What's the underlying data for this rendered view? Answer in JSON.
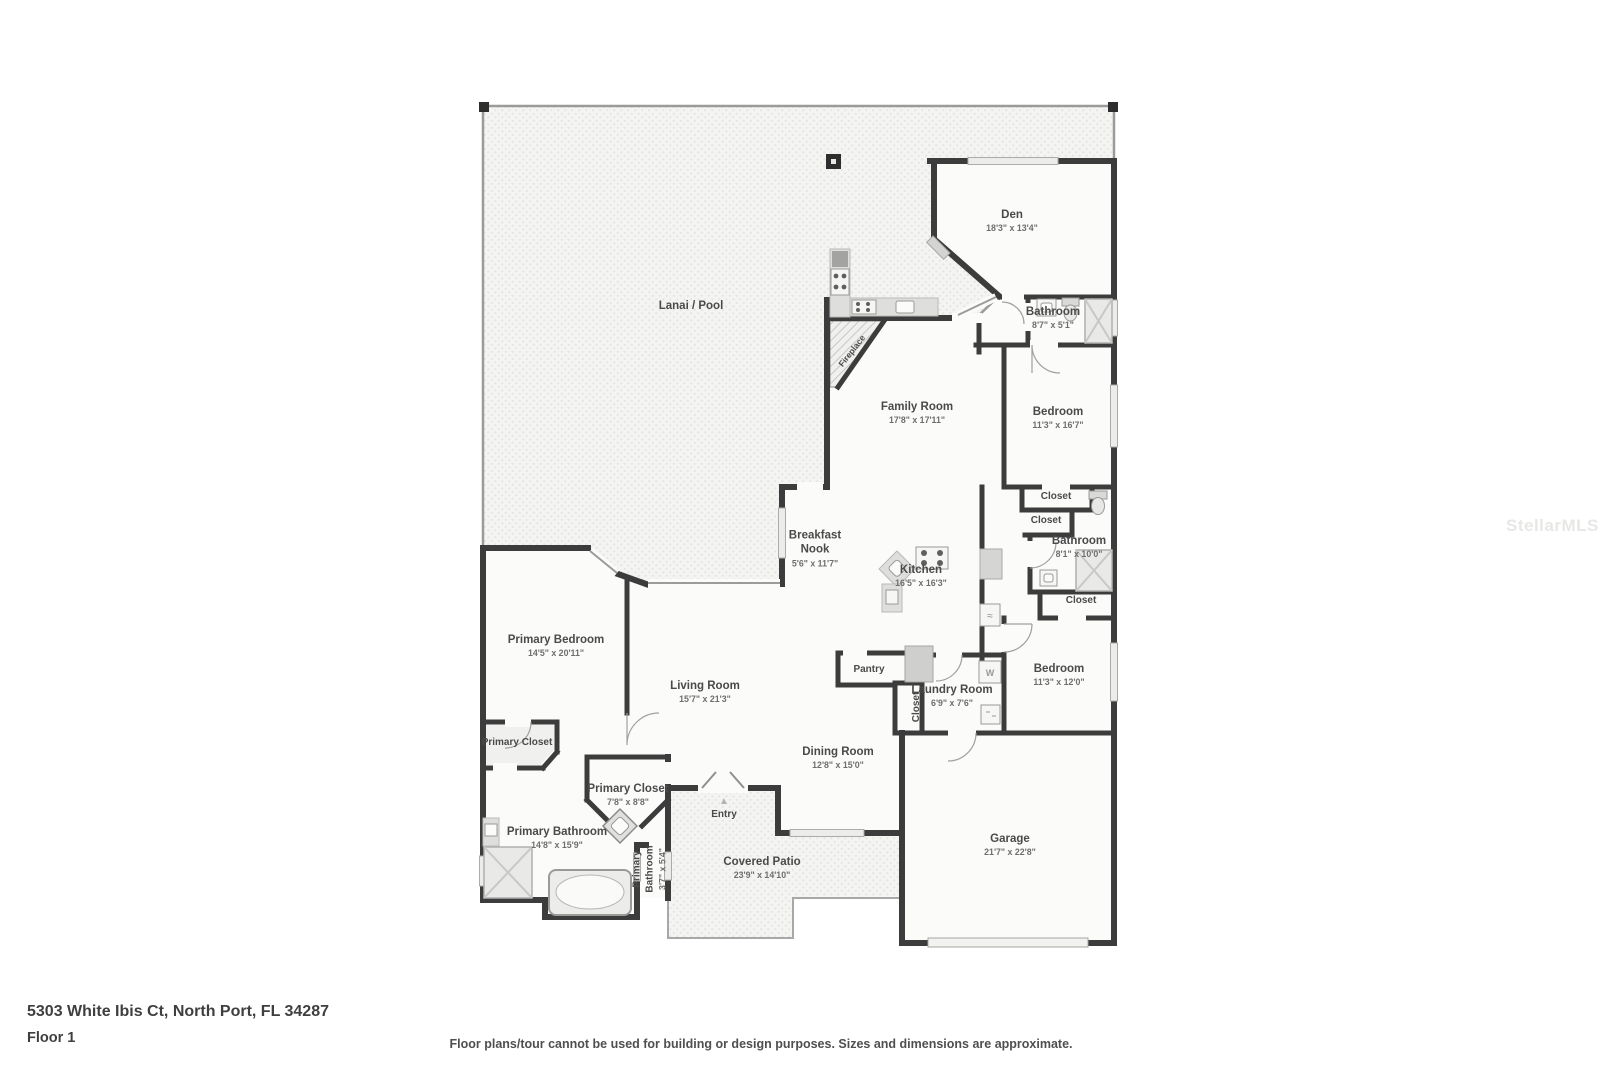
{
  "meta": {
    "address": "5303 White Ibis Ct, North Port, FL 34287",
    "floor": "Floor 1",
    "disclaimer": "Floor plans/tour cannot be used for building or design purposes. Sizes and dimensions are approximate.",
    "watermark": "StellarMLS"
  },
  "colors": {
    "wall": "#3c3c3c",
    "floor": "#fbfbfa",
    "label": "#4a4a4a",
    "dims": "#6e6e6e",
    "watermark": "#e7e7e5"
  },
  "rooms": [
    {
      "name": "Lanai / Pool",
      "x": 691,
      "y": 306
    },
    {
      "name": "Den",
      "dims": "18'3\" x 13'4\"",
      "x": 1012,
      "y": 221
    },
    {
      "name": "Bathroom",
      "dims": "8'7\" x 5'1\"",
      "x": 1053,
      "y": 318
    },
    {
      "name": "Family Room",
      "dims": "17'8\" x 17'11\"",
      "x": 917,
      "y": 413
    },
    {
      "name": "Bedroom",
      "dims": "11'3\" x 16'7\"",
      "x": 1058,
      "y": 418
    },
    {
      "name": "Closet",
      "x": 1056,
      "y": 497,
      "cls": "small"
    },
    {
      "name": "Closet",
      "x": 1046,
      "y": 521,
      "cls": "small"
    },
    {
      "name": "Bathroom",
      "dims": "8'1\" x 10'0\"",
      "x": 1079,
      "y": 547
    },
    {
      "name": "Closet",
      "x": 1081,
      "y": 601,
      "cls": "small"
    },
    {
      "name": "Breakfast\nNook",
      "dims": "5'6\" x 11'7\"",
      "x": 815,
      "y": 549
    },
    {
      "name": "Kitchen",
      "dims": "16'5\" x 16'3\"",
      "x": 921,
      "y": 576
    },
    {
      "name": "Bedroom",
      "dims": "11'3\" x 12'0\"",
      "x": 1059,
      "y": 675
    },
    {
      "name": "Pantry",
      "x": 869,
      "y": 670,
      "cls": "small"
    },
    {
      "name": "Laundry Room",
      "dims": "6'9\" x 7'6\"",
      "x": 952,
      "y": 696
    },
    {
      "name": "Closet",
      "x": 917,
      "y": 707,
      "cls": "small",
      "rotate": -90
    },
    {
      "name": "Primary Bedroom",
      "dims": "14'5\" x 20'11\"",
      "x": 556,
      "y": 646
    },
    {
      "name": "Living Room",
      "dims": "15'7\" x 21'3\"",
      "x": 705,
      "y": 692
    },
    {
      "name": "Dining Room",
      "dims": "12'8\" x 15'0\"",
      "x": 838,
      "y": 758
    },
    {
      "name": "Primary Closet",
      "x": 517,
      "y": 743,
      "cls": "small"
    },
    {
      "name": "Primary Closet",
      "dims": "7'8\" x 8'8\"",
      "x": 628,
      "y": 795
    },
    {
      "name": "Primary Bathroom",
      "dims": "14'8\" x 15'9\"",
      "x": 557,
      "y": 838
    },
    {
      "name": "Primary\nBathroom",
      "dims": "3'7\" x 5'4\"",
      "x": 650,
      "y": 869,
      "rotate": -90,
      "cls": "small"
    },
    {
      "name": "Entry",
      "x": 724,
      "y": 809,
      "cls": "small",
      "icon": "▲"
    },
    {
      "name": "Covered Patio",
      "dims": "23'9\" x 14'10\"",
      "x": 762,
      "y": 868
    },
    {
      "name": "Garage",
      "dims": "21'7\" x 22'8\"",
      "x": 1010,
      "y": 845
    },
    {
      "name": "Fireplace",
      "x": 852,
      "y": 351,
      "rotate": -52,
      "cls": "tiny"
    }
  ]
}
